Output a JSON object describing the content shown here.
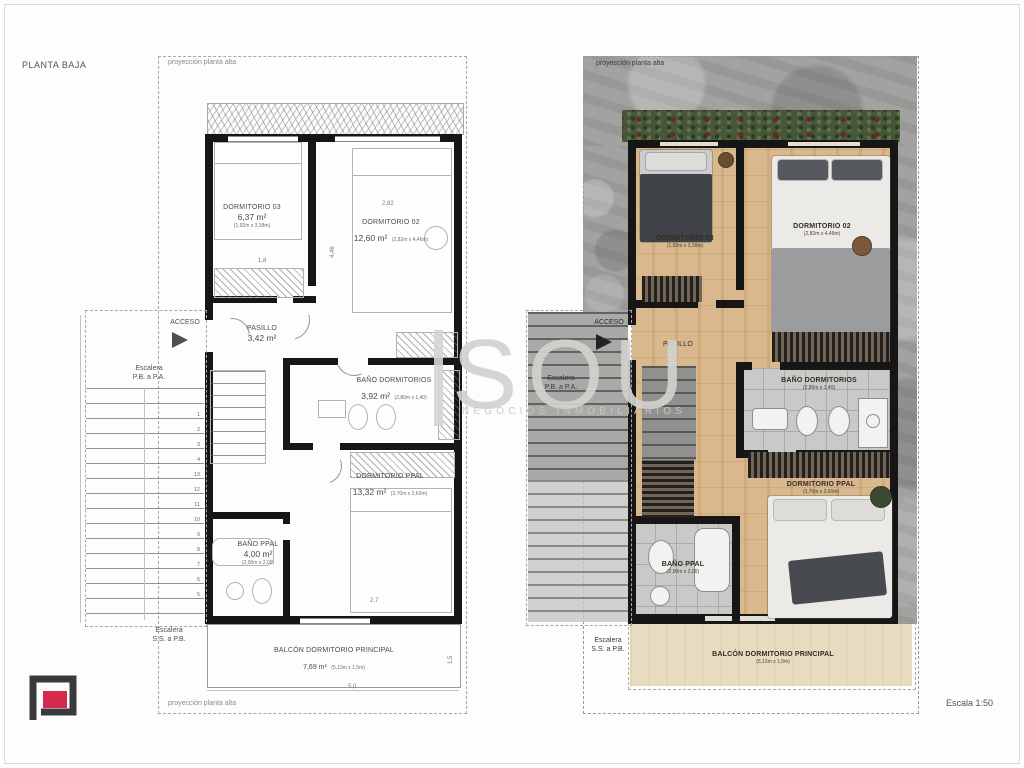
{
  "page": {
    "title": "PLANTA BAJA",
    "scale_label": "Escala 1:50"
  },
  "watermark": {
    "text": "SOU",
    "subtext": "NEGOCIOS INMOBILIARIOS"
  },
  "left_plan": {
    "projection_top": "proyección planta alta",
    "projection_bottom": "proyección planta alta",
    "acceso": "ACCESO",
    "stairs_upper_line1": "Escalera",
    "stairs_upper_line2": "P.B. a P.A.",
    "stairs_lower_line1": "Escalera",
    "stairs_lower_line2": "S.S. a P.B.",
    "rooms": {
      "dorm03": {
        "name": "DORMITORIO 03",
        "area": "6,37 m²",
        "dims": "(1,92m x 3,38m)"
      },
      "dorm02": {
        "name": "DORMITORIO 02",
        "area": "12,60 m²",
        "dims": "(2,82m x 4,46m)"
      },
      "pasillo": {
        "name": "PASILLO",
        "area": "3,42 m²",
        "dims": ""
      },
      "bano_dorm": {
        "name": "BAÑO DORMITORIOS",
        "area": "3,92 m²",
        "dims": "(2,80m x 1,40)"
      },
      "dorm_ppal": {
        "name": "DORMITORIO PPAL",
        "area": "13,32 m²",
        "dims": "(3,70m x 3,60m)"
      },
      "bano_ppal": {
        "name": "BAÑO PPAL",
        "area": "4,00 m²",
        "dims": "(2,00m x 2,00)"
      },
      "balcon": {
        "name": "BALCÓN DORMITORIO PRINCIPAL",
        "area": "7,69 m²",
        "dims": "(5,13m x 1,5m)"
      }
    },
    "stair_numbers": [
      "1",
      "2",
      "3",
      "4",
      "13",
      "12",
      "11",
      "10",
      "9",
      "8",
      "7",
      "6",
      "5"
    ],
    "dims": {
      "d02_w": "2,82",
      "d02_h": "4,46",
      "d03_w": "1,8",
      "ppal_w": "2,7",
      "balcon_h": "1,5",
      "balcon_w": "5,0"
    }
  },
  "right_plan": {
    "projection_top": "proyección planta alta",
    "acceso": "ACCESO",
    "stairs_upper_line1": "Escalera",
    "stairs_upper_line2": "P.B. a P.A.",
    "stairs_lower_line1": "Escalera",
    "stairs_lower_line2": "S.S. a P.B.",
    "rooms": {
      "dorm03": {
        "name": "DORMITORIO 03",
        "dims": "(1,92m x 3,38m)"
      },
      "dorm02": {
        "name": "DORMITORIO 02",
        "dims": "(2,82m x 4,46m)"
      },
      "pasillo": {
        "name": "PASILLO",
        "dims": ""
      },
      "bano_dorm": {
        "name": "BAÑO DORMITORIOS",
        "dims": "(2,80m x 1,40)"
      },
      "dorm_ppal": {
        "name": "DORMITORIO PPAL",
        "dims": "(3,70m x 3,60m)"
      },
      "bano_ppal": {
        "name": "BAÑO PPAL",
        "dims": "(2,00m x 2,00)"
      },
      "balcon": {
        "name": "BALCÓN DORMITORIO PRINCIPAL",
        "dims": "(5,13m x 1,5m)"
      }
    }
  },
  "colors": {
    "wall": "#161616",
    "wood_floor": "#d9b88d",
    "concrete": "#a2a2a0",
    "hedge_green": "#46563a",
    "flower_red": "#6e2330",
    "tile_gray": "#c9c9c7",
    "balcony_cream": "#e8dcc0",
    "logo_dark": "#3a3a3c",
    "logo_red": "#d5294d",
    "watermark_gray": "#d1d1ce"
  }
}
